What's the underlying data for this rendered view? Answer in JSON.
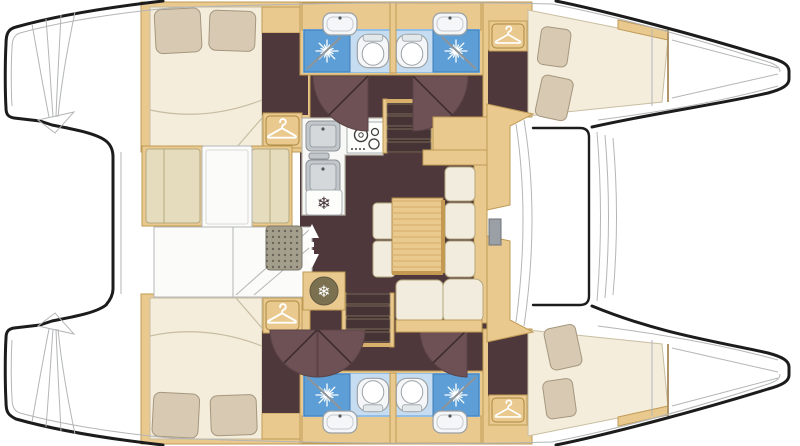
{
  "figure": {
    "kind": "boat-interior-floor-plan",
    "vessel": "catamaran",
    "orientation": "bow-right, twin hulls top and bottom, saloon on bridgedeck"
  },
  "palette": {
    "background": "#ffffff",
    "hull_line": "#1c1c1c",
    "deck_line": "#b3b5b7",
    "floor": "#4f383b",
    "door": "#6d5154",
    "wood": "#eac98f",
    "wood_dark": "#bf9a55",
    "wood_grain": "#d9b06b",
    "cushion": "#e5dcbd",
    "cushion_edge": "#b5a87f",
    "mattress": "#f4eddc",
    "mattress_edge": "#c9bda1",
    "pillow": "#d8cab2",
    "pillow_edge": "#a5977e",
    "bath_floor": "#92bde4",
    "bath_floor_light": "#c6ddf1",
    "shower": "#5c9ed5",
    "shower_edge": "#3f7fba",
    "fixture": "#f4f6f7",
    "fixture_edge": "#9aa0a5",
    "sink_steel": "#c2c7cb",
    "mat": "#a49e8c",
    "mat_dot": "#6c665a",
    "step": "#402f31",
    "step_edge": "#8a7a62",
    "icon_dark": "#433236",
    "fridge_disc": "#7b7150",
    "counter": "#f8f8f6",
    "white_panel": "#fbfbf9",
    "panel_edge": "#b5b7b9"
  },
  "icons": {
    "snowflake": {
      "glyph": "❄",
      "meaning": "refrigerator / freezer"
    },
    "hanger": {
      "meaning": "wardrobe"
    },
    "starburst": {
      "meaning": "shower head"
    },
    "arrows": {
      "meaning": "companionway up-down"
    }
  },
  "rooms": [
    {
      "id": "upper-aft-cabin",
      "label": "aft double cabin",
      "features": [
        "double-bed",
        "two-pillows",
        "wardrobe"
      ]
    },
    {
      "id": "lower-aft-cabin",
      "label": "aft double cabin",
      "features": [
        "double-bed",
        "two-pillows",
        "wardrobe"
      ]
    },
    {
      "id": "upper-heads",
      "label": "two bathrooms",
      "features": [
        "shower",
        "toilet",
        "washbasin"
      ]
    },
    {
      "id": "lower-heads",
      "label": "two bathrooms",
      "features": [
        "shower",
        "toilet",
        "washbasin"
      ]
    },
    {
      "id": "upper-bow-cabin",
      "label": "forward double cabin",
      "features": [
        "v-berth",
        "two-pillows",
        "wardrobe"
      ]
    },
    {
      "id": "lower-bow-cabin",
      "label": "forward double cabin",
      "features": [
        "v-berth",
        "two-pillows",
        "wardrobe"
      ]
    },
    {
      "id": "galley",
      "label": "galley",
      "features": [
        "double-sink",
        "stove",
        "freezer"
      ]
    },
    {
      "id": "saloon",
      "label": "saloon",
      "features": [
        "table",
        "sofa",
        "fridge"
      ]
    },
    {
      "id": "cockpit",
      "label": "cockpit",
      "features": [
        "bench-cushions",
        "table",
        "deck-mat",
        "hatches"
      ]
    }
  ]
}
